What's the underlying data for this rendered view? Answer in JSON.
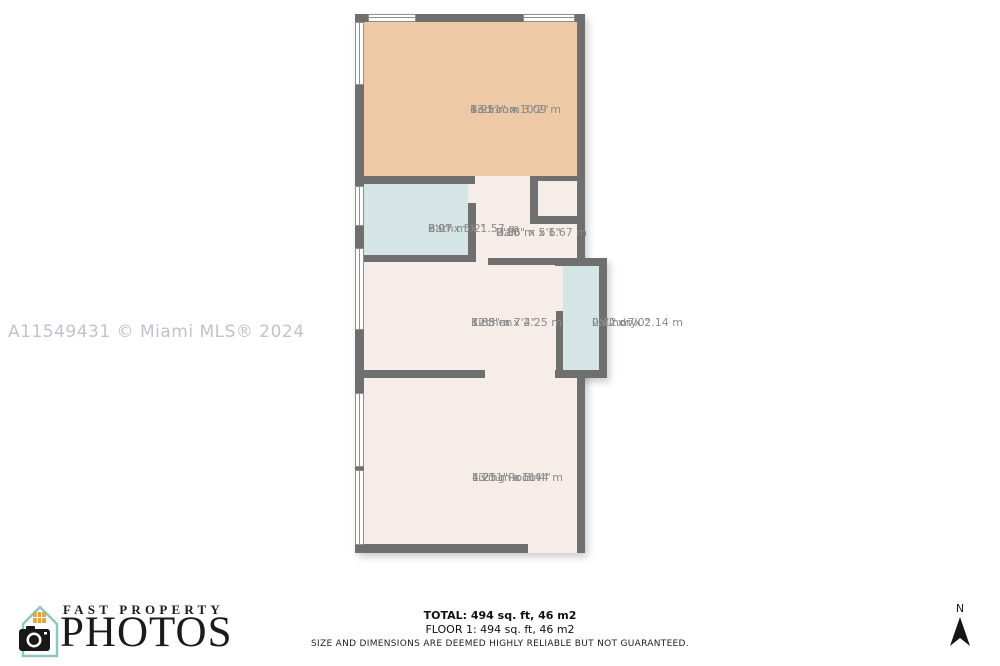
{
  "watermark": "A11549431 © Miami MLS® 2024",
  "floorplan": {
    "rooms": [
      {
        "name": "Bedroom",
        "dims_ft": "13'11\" x 10'2\"",
        "dims_m": "4.25 m x 3.09 m"
      },
      {
        "name": "Bath",
        "dims_ft": "6'9\" x 5'2\"",
        "dims_m": "2.07 m x 1.57 m"
      },
      {
        "name": "Hall",
        "dims_ft": "2'10\" x 5'6\"",
        "dims_m": "0.86 m x 1.67 m"
      },
      {
        "name": "Kitchen",
        "dims_ft": "12'8\" x 7'4\"",
        "dims_m": "3.85 m x 2.25 m"
      },
      {
        "name": "Laundry",
        "dims_ft": "2'4\" x 7'0\"",
        "dims_m": "0.72 m x 2.14 m"
      },
      {
        "name": "Living Room",
        "dims_ft": "13'11\" x 11'4\"",
        "dims_m": "4.25 m x 3.44 m"
      }
    ],
    "colors": {
      "wall": "#6f6f6f",
      "bedroom_fill": "#edc9a5",
      "wet_fill": "#d5e4e5",
      "floor_fill": "#f6ede8",
      "label_text": "#8c8c8c",
      "watermark_text": "#c0c3ca",
      "logo_teal": "#8fc6c2",
      "logo_orange": "#e8a33d"
    }
  },
  "footer": {
    "total": "TOTAL: 494 sq. ft, 46 m2",
    "floor1": "FLOOR 1: 494 sq. ft, 46 m2",
    "disclaimer": "SIZE AND DIMENSIONS ARE DEEMED HIGHLY RELIABLE BUT NOT GUARANTEED."
  },
  "logo": {
    "line1": "FAST PROPERTY",
    "line2": "PHOTOS"
  },
  "compass": {
    "label": "N"
  }
}
